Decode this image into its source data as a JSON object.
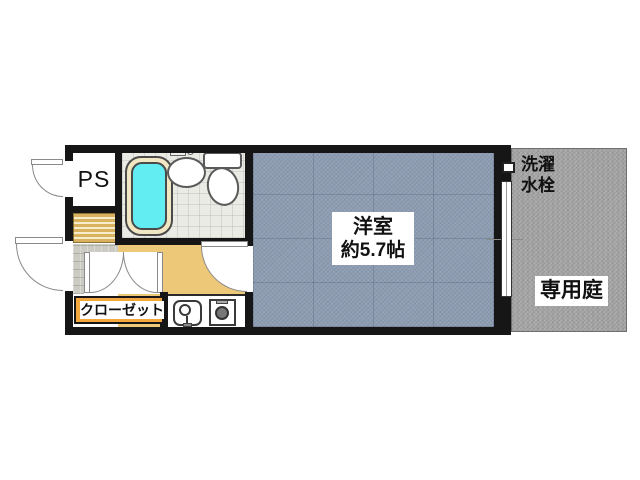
{
  "floorplan": {
    "labels": {
      "ps": "PS",
      "closet": "クローゼット",
      "room_name": "洋室",
      "room_size": "約5.7帖",
      "garden": "専用庭",
      "laundry_line1": "洗濯",
      "laundry_line2": "水栓"
    },
    "colors": {
      "wall": "#161616",
      "western_room_fill": "#8E9DB2",
      "garden_fill": "#A7A7A7",
      "kitchen_fill": "#EDC878",
      "bathtub_water": "#62EDF2",
      "bathtub_rim": "#F1E7C2",
      "closet_label_bg": "#F3A83D",
      "steps_stripe": "#D9B25F",
      "bath_floor": "#EBEBE6",
      "entry_tile": "#CBCBC4"
    }
  }
}
